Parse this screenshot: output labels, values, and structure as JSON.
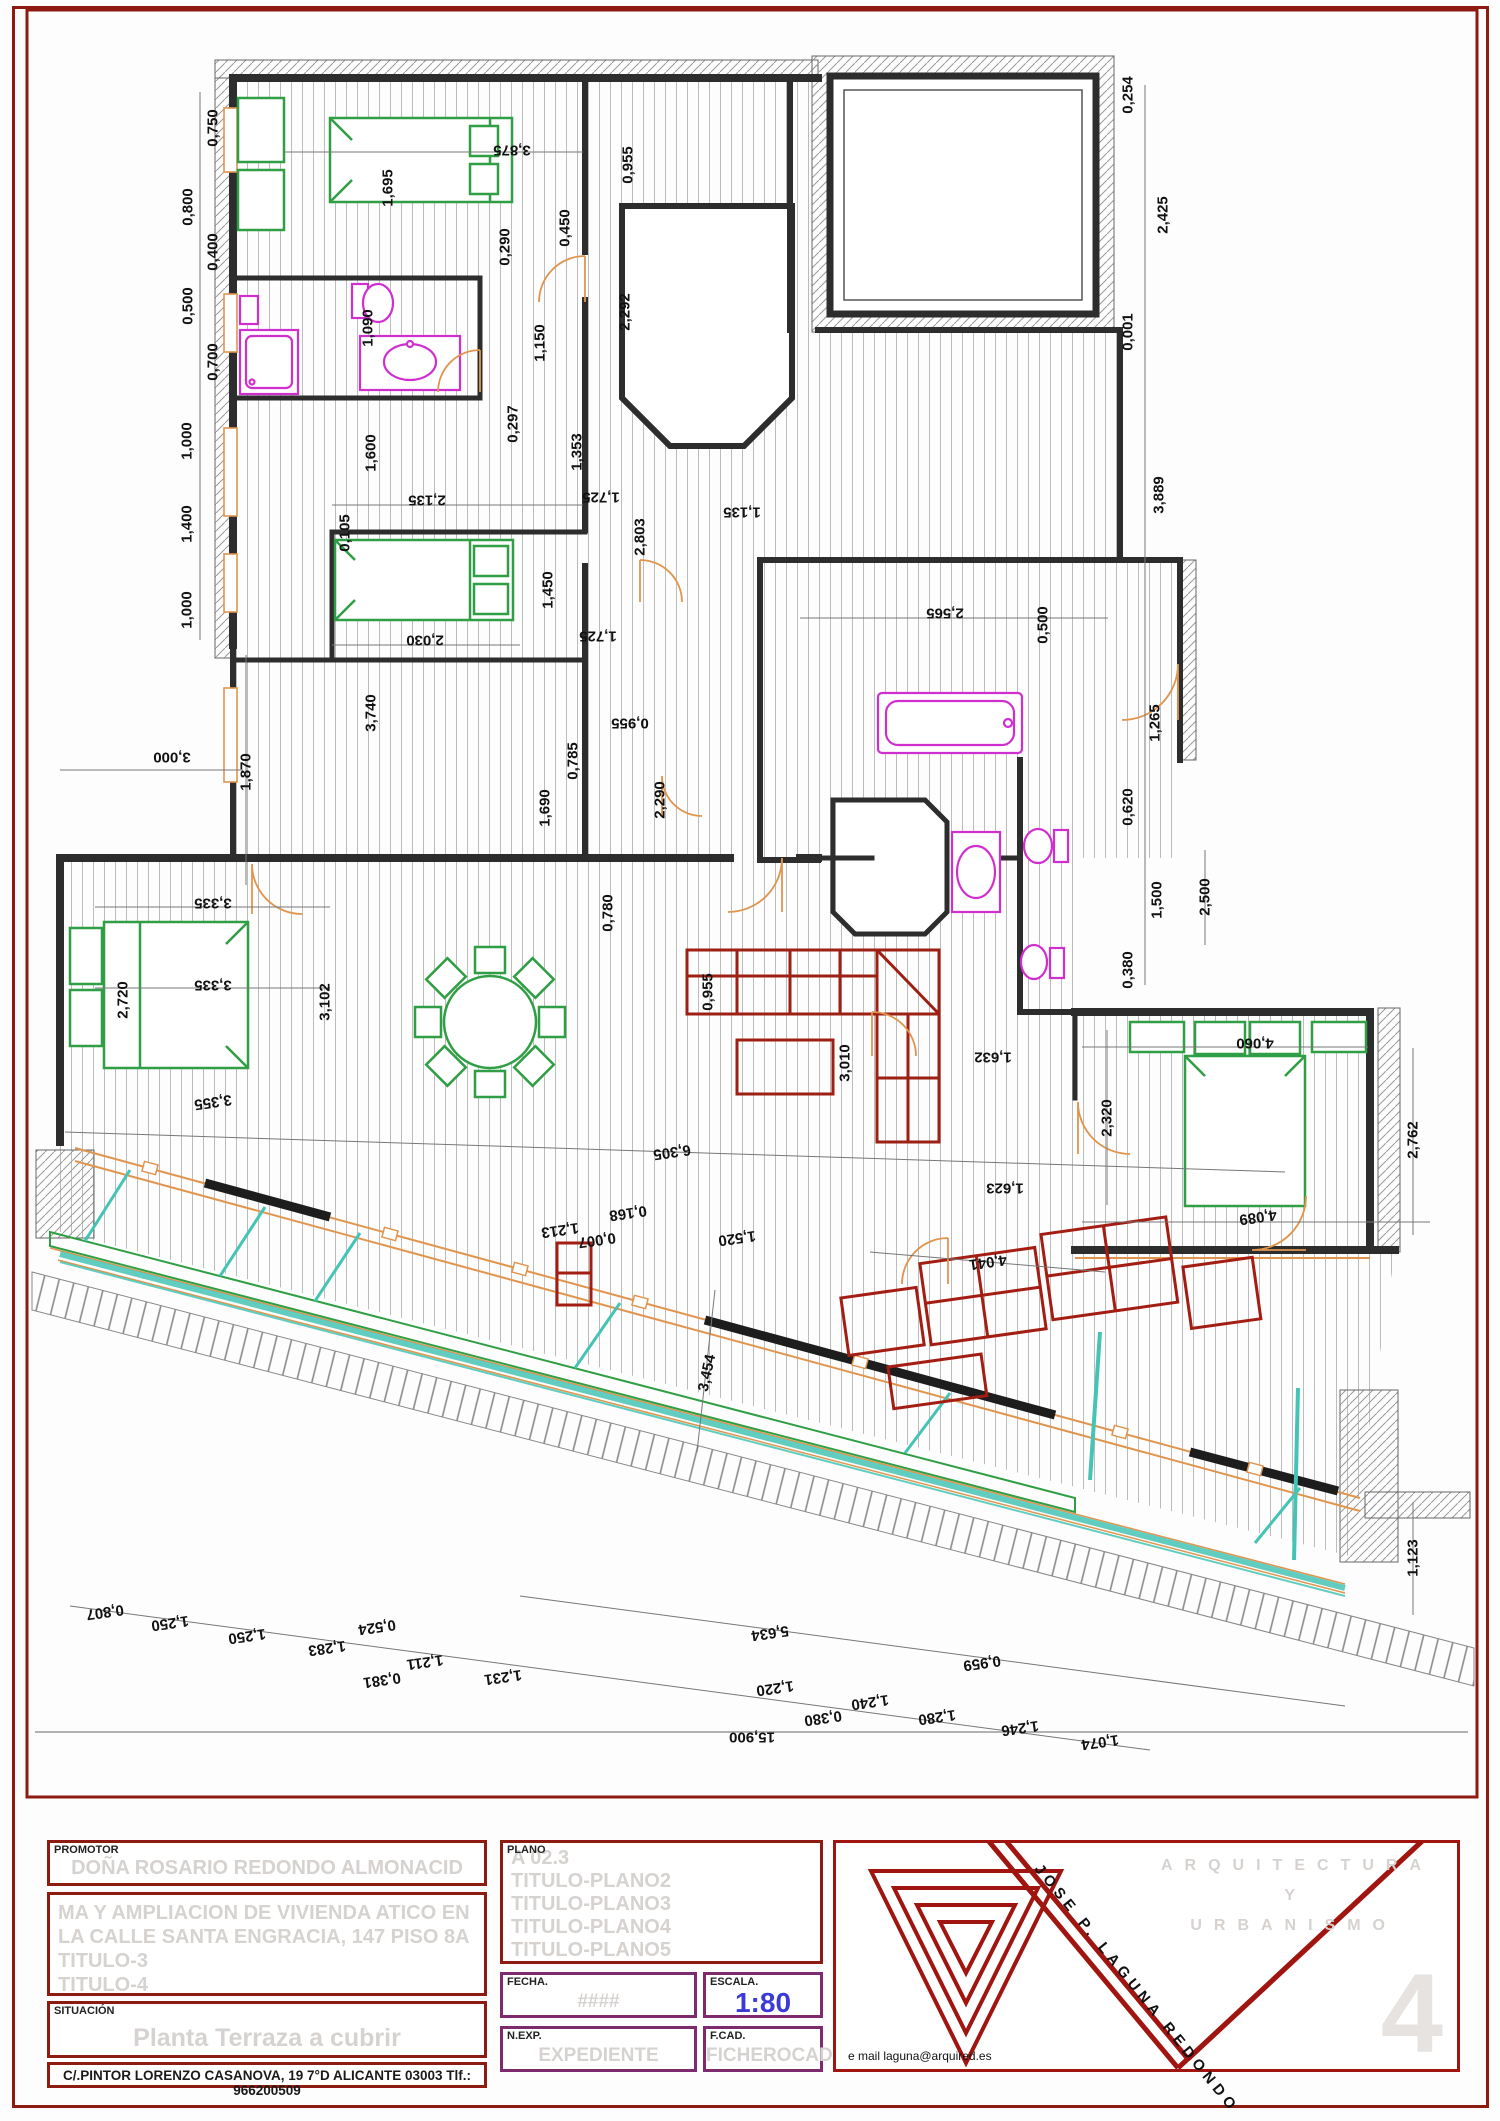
{
  "plan": {
    "dimension_labels": [
      {
        "t": "0,750",
        "x": 213,
        "y": 128,
        "r": -90
      },
      {
        "t": "0,800",
        "x": 188,
        "y": 207,
        "r": -90
      },
      {
        "t": "0,400",
        "x": 213,
        "y": 252,
        "r": -90
      },
      {
        "t": "0,500",
        "x": 188,
        "y": 306,
        "r": -90
      },
      {
        "t": "0,700",
        "x": 213,
        "y": 362,
        "r": -90
      },
      {
        "t": "1,000",
        "x": 187,
        "y": 441,
        "r": -90
      },
      {
        "t": "1,400",
        "x": 187,
        "y": 524,
        "r": -90
      },
      {
        "t": "1,000",
        "x": 187,
        "y": 610,
        "r": -90
      },
      {
        "t": "3,000",
        "x": 172,
        "y": 757,
        "r": 180
      },
      {
        "t": "1,870",
        "x": 246,
        "y": 772,
        "r": -90
      },
      {
        "t": "3,875",
        "x": 512,
        "y": 150,
        "r": 180
      },
      {
        "t": "1,695",
        "x": 388,
        "y": 188,
        "r": -90
      },
      {
        "t": "1,090",
        "x": 368,
        "y": 328,
        "r": -90
      },
      {
        "t": "0,290",
        "x": 505,
        "y": 247,
        "r": -90
      },
      {
        "t": "0,450",
        "x": 565,
        "y": 228,
        "r": -90
      },
      {
        "t": "1,150",
        "x": 540,
        "y": 343,
        "r": -90
      },
      {
        "t": "0,297",
        "x": 513,
        "y": 424,
        "r": -90
      },
      {
        "t": "2,292",
        "x": 625,
        "y": 312,
        "r": -90
      },
      {
        "t": "0,955",
        "x": 628,
        "y": 165,
        "r": -90
      },
      {
        "t": "1,353",
        "x": 577,
        "y": 452,
        "r": -90
      },
      {
        "t": "1,725",
        "x": 601,
        "y": 497,
        "r": 180
      },
      {
        "t": "2,135",
        "x": 427,
        "y": 500,
        "r": 180
      },
      {
        "t": "1,135",
        "x": 742,
        "y": 512,
        "r": 180
      },
      {
        "t": "2,803",
        "x": 640,
        "y": 537,
        "r": -90
      },
      {
        "t": "0,105",
        "x": 345,
        "y": 533,
        "r": -90
      },
      {
        "t": "1,600",
        "x": 371,
        "y": 453,
        "r": -90
      },
      {
        "t": "1,450",
        "x": 548,
        "y": 590,
        "r": -90
      },
      {
        "t": "1,725",
        "x": 598,
        "y": 636,
        "r": 180
      },
      {
        "t": "2,030",
        "x": 425,
        "y": 640,
        "r": 180
      },
      {
        "t": "3,740",
        "x": 371,
        "y": 713,
        "r": -90
      },
      {
        "t": "0,955",
        "x": 630,
        "y": 723,
        "r": 180
      },
      {
        "t": "0,785",
        "x": 573,
        "y": 761,
        "r": -90
      },
      {
        "t": "1,690",
        "x": 545,
        "y": 808,
        "r": -90
      },
      {
        "t": "2,290",
        "x": 660,
        "y": 800,
        "r": -90
      },
      {
        "t": "0,780",
        "x": 608,
        "y": 913,
        "r": -90
      },
      {
        "t": "0,254",
        "x": 1128,
        "y": 95,
        "r": -90
      },
      {
        "t": "2,425",
        "x": 1163,
        "y": 215,
        "r": -90
      },
      {
        "t": "0,001",
        "x": 1128,
        "y": 332,
        "r": -90
      },
      {
        "t": "3,889",
        "x": 1159,
        "y": 495,
        "r": -90
      },
      {
        "t": "2,565",
        "x": 945,
        "y": 613,
        "r": 180
      },
      {
        "t": "0,500",
        "x": 1043,
        "y": 625,
        "r": -90
      },
      {
        "t": "1,265",
        "x": 1155,
        "y": 723,
        "r": -90
      },
      {
        "t": "0,620",
        "x": 1128,
        "y": 807,
        "r": -90
      },
      {
        "t": "1,500",
        "x": 1157,
        "y": 900,
        "r": -90
      },
      {
        "t": "2,500",
        "x": 1205,
        "y": 897,
        "r": -90
      },
      {
        "t": "0,380",
        "x": 1128,
        "y": 970,
        "r": -90
      },
      {
        "t": "1,632",
        "x": 993,
        "y": 1057,
        "r": 180
      },
      {
        "t": "1,623",
        "x": 1005,
        "y": 1188,
        "r": 180
      },
      {
        "t": "2,320",
        "x": 1107,
        "y": 1118,
        "r": -90
      },
      {
        "t": "3,010",
        "x": 845,
        "y": 1063,
        "r": -90
      },
      {
        "t": "0,955",
        "x": 708,
        "y": 992,
        "r": -90
      },
      {
        "t": "4,060",
        "x": 1255,
        "y": 1043,
        "r": 180
      },
      {
        "t": "4,089",
        "x": 1258,
        "y": 1217,
        "r": 172
      },
      {
        "t": "2,762",
        "x": 1413,
        "y": 1140,
        "r": -90
      },
      {
        "t": "3,335",
        "x": 213,
        "y": 903,
        "r": 180
      },
      {
        "t": "3,335",
        "x": 213,
        "y": 985,
        "r": 180
      },
      {
        "t": "3,355",
        "x": 213,
        "y": 1102,
        "r": 172
      },
      {
        "t": "2,720",
        "x": 123,
        "y": 1000,
        "r": -90
      },
      {
        "t": "3,102",
        "x": 325,
        "y": 1002,
        "r": -90
      },
      {
        "t": "6,305",
        "x": 672,
        "y": 1152,
        "r": 172
      },
      {
        "t": "1,213",
        "x": 560,
        "y": 1230,
        "r": 172
      },
      {
        "t": "0,168",
        "x": 628,
        "y": 1213,
        "r": 172
      },
      {
        "t": "0,007",
        "x": 597,
        "y": 1240,
        "r": 172
      },
      {
        "t": "1,520",
        "x": 737,
        "y": 1238,
        "r": 172
      },
      {
        "t": "3,454",
        "x": 707,
        "y": 1373,
        "r": -78
      },
      {
        "t": "4,041",
        "x": 988,
        "y": 1262,
        "r": 172
      },
      {
        "t": "5,634",
        "x": 770,
        "y": 1633,
        "r": 172
      },
      {
        "t": "0,959",
        "x": 982,
        "y": 1663,
        "r": 172
      },
      {
        "t": "15,900",
        "x": 752,
        "y": 1737,
        "r": 180
      },
      {
        "t": "1,123",
        "x": 1413,
        "y": 1558,
        "r": -90
      },
      {
        "t": "0,807",
        "x": 105,
        "y": 1612,
        "r": 172
      },
      {
        "t": "1,250",
        "x": 170,
        "y": 1623,
        "r": 172
      },
      {
        "t": "1,250",
        "x": 247,
        "y": 1636,
        "r": 172
      },
      {
        "t": "1,283",
        "x": 327,
        "y": 1648,
        "r": 172
      },
      {
        "t": "0,524",
        "x": 377,
        "y": 1627,
        "r": 172
      },
      {
        "t": "0,381",
        "x": 382,
        "y": 1680,
        "r": 172
      },
      {
        "t": "1,211",
        "x": 425,
        "y": 1662,
        "r": 172
      },
      {
        "t": "1,231",
        "x": 503,
        "y": 1677,
        "r": 172
      },
      {
        "t": "1,220",
        "x": 775,
        "y": 1688,
        "r": 172
      },
      {
        "t": "0,380",
        "x": 823,
        "y": 1718,
        "r": 172
      },
      {
        "t": "1,240",
        "x": 870,
        "y": 1702,
        "r": 172
      },
      {
        "t": "1,280",
        "x": 937,
        "y": 1717,
        "r": 172
      },
      {
        "t": "1,246",
        "x": 1020,
        "y": 1728,
        "r": 172
      },
      {
        "t": "1,074",
        "x": 1100,
        "y": 1742,
        "r": 172
      }
    ]
  },
  "title_block": {
    "promotor_label": "PROMOTOR",
    "promotor_value": "DOÑA ROSARIO REDONDO ALMONACID",
    "project_lines": [
      "MA Y AMPLIACION DE VIVIENDA  ATICO EN",
      "LA CALLE SANTA ENGRACIA, 147 PISO 8A",
      "TITULO-3",
      "TITULO-4"
    ],
    "situacion_label": "SITUACIÓN",
    "situacion_value": "Planta Terraza a cubrir",
    "address": "C/.PINTOR LORENZO CASANOVA, 19 7°D ALICANTE 03003 Tlf.: 966200509",
    "plano_label": "PLANO",
    "plano_lines": [
      "A 02.3",
      "TITULO-PLANO2",
      "TITULO-PLANO3",
      "TITULO-PLANO4",
      "TITULO-PLANO5"
    ],
    "fecha_label": "FECHA.",
    "fecha_value": "####",
    "escala_label": "ESCALA.",
    "escala_value": "1:80",
    "nexp_label": "N.EXP.",
    "nexp_value": "EXPEDIENTE",
    "fcad_label": "F.CAD.",
    "fcad_value": "FICHEROCAD",
    "firm_line1": "ARQUITECTURA",
    "firm_line2": "Y",
    "firm_line3": "URBANISMO",
    "architect": "JOSE P. LAGUNA REDONDO",
    "email": "e mail laguna@arquired.es",
    "sheet_number": "4"
  },
  "colors": {
    "frame_red": "#8e1b12",
    "purple_border": "#7d2a6e",
    "ghost_text": "#d6d2d0",
    "scale_blue": "#3a3ada",
    "wall_dark": "#2d2d2d",
    "furniture_green": "#2f9e44",
    "fixture_magenta": "#cf2fcf",
    "sofa_dark_red": "#9e1f14",
    "terrace_red": "#a31d12",
    "door_orange": "#e0954e",
    "awning_teal": "#45c4b5"
  }
}
